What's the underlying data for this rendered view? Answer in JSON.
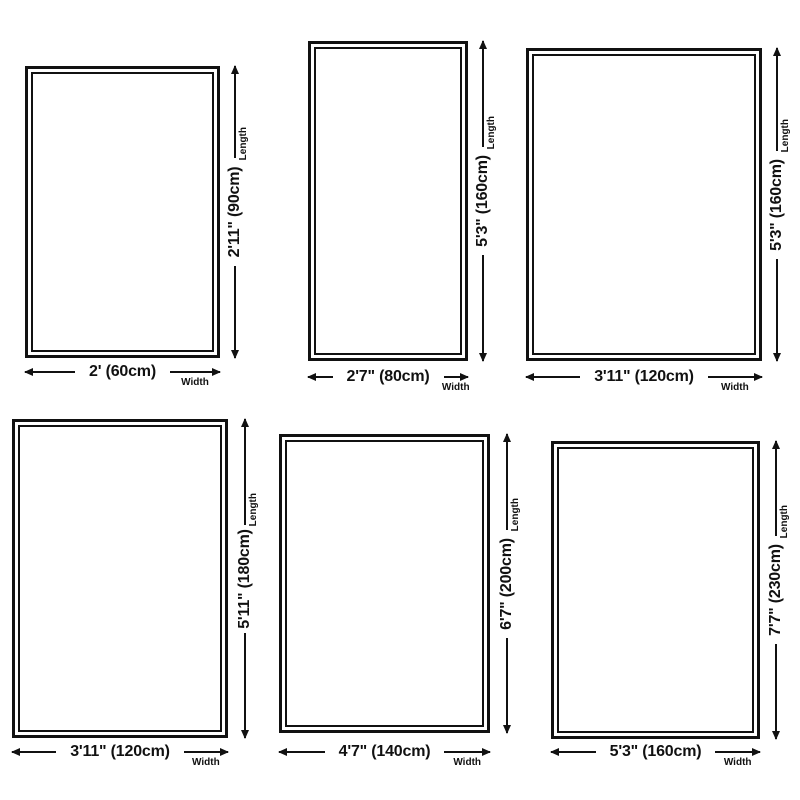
{
  "labels": {
    "length_caption": "Length",
    "width_caption": "Width"
  },
  "colors": {
    "background": "#ffffff",
    "line": "#111111",
    "text": "#111111"
  },
  "panels": [
    {
      "length_label": "2'11\" (90cm)",
      "width_label": "2' (60cm)"
    },
    {
      "length_label": "5'3\" (160cm)",
      "width_label": "2'7\" (80cm)"
    },
    {
      "length_label": "5'3\" (160cm)",
      "width_label": "3'11\" (120cm)"
    },
    {
      "length_label": "5'11\" (180cm)",
      "width_label": "3'11\" (120cm)"
    },
    {
      "length_label": "6'7\" (200cm)",
      "width_label": "4'7\" (140cm)"
    },
    {
      "length_label": "7'7\" (230cm)",
      "width_label": "5'3\" (160cm)"
    }
  ]
}
